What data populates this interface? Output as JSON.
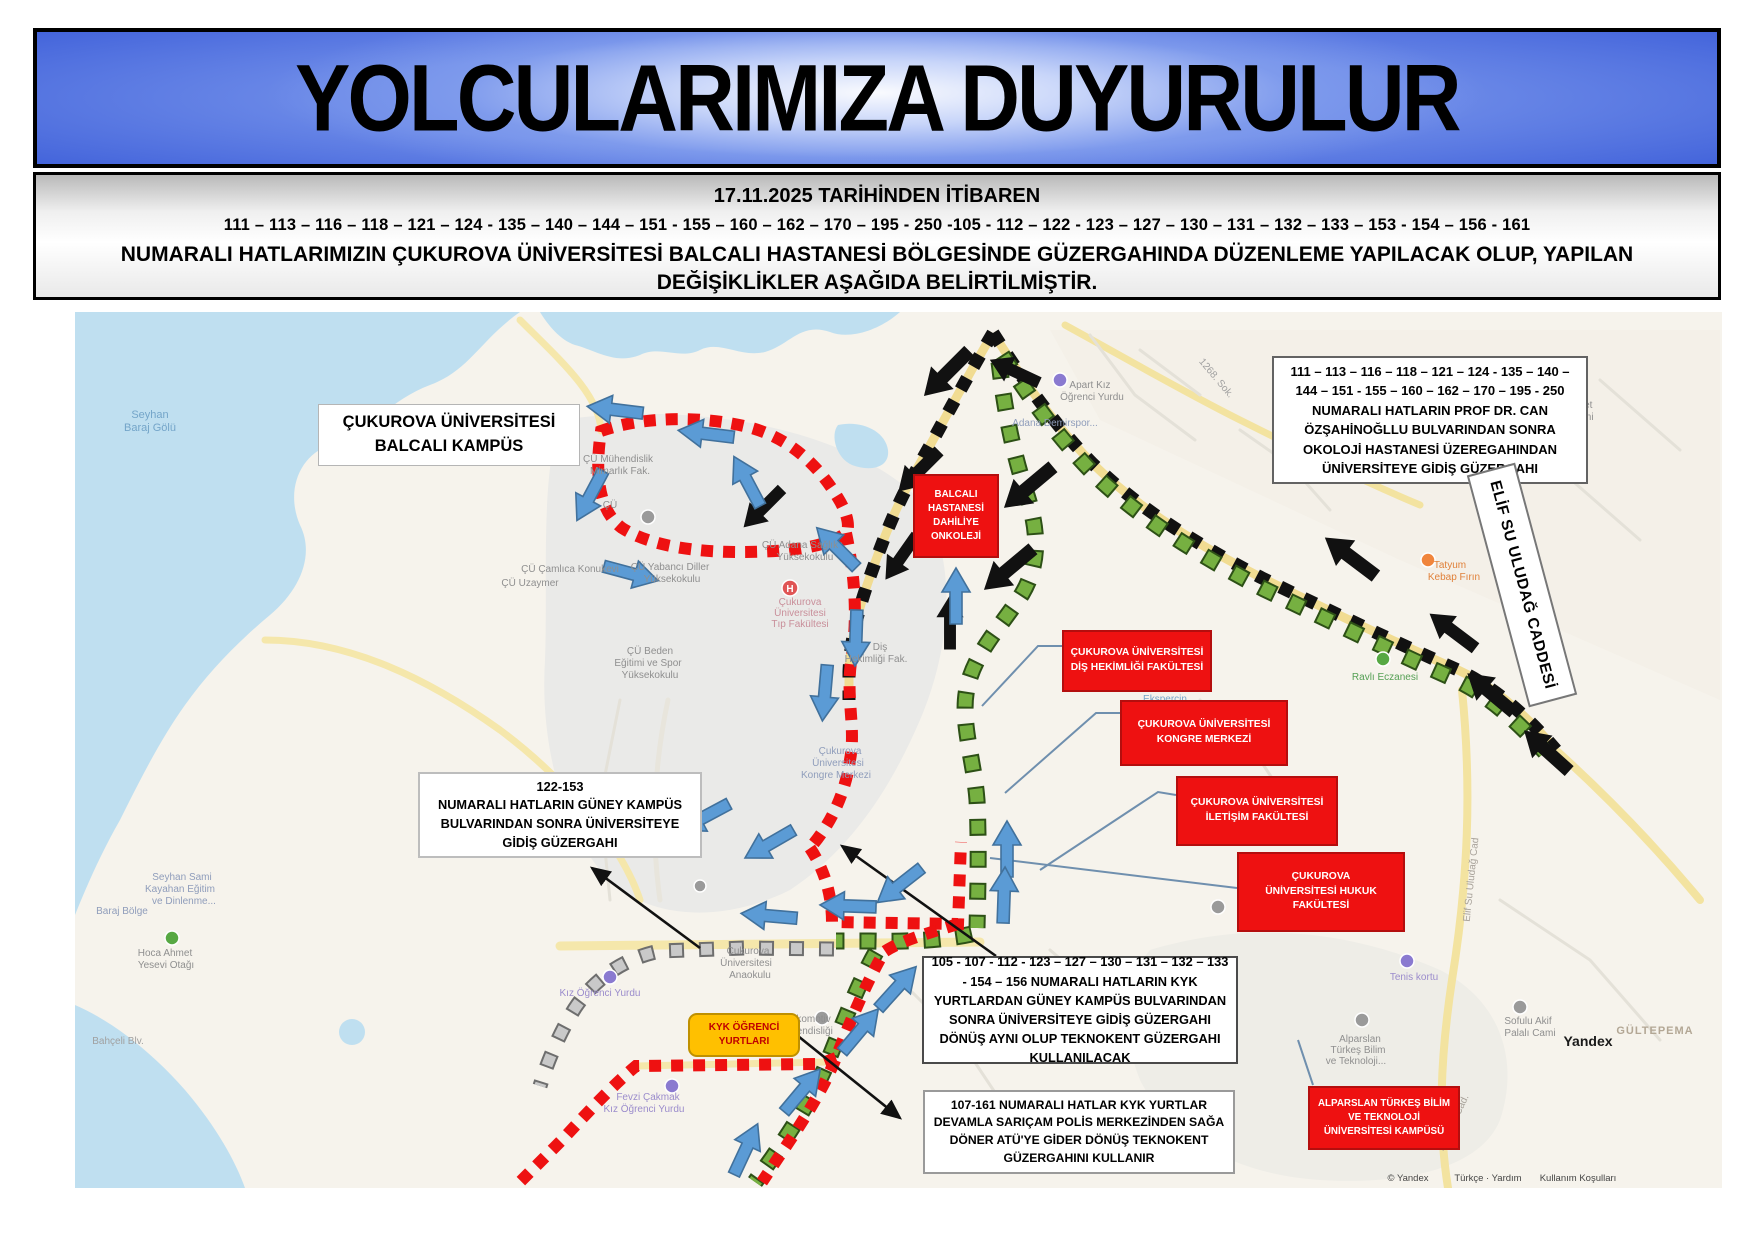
{
  "header": {
    "title": "YOLCULARIMIZA DUYURULUR"
  },
  "notice": {
    "line1": "17.11.2025 TARİHİNDEN İTİBAREN",
    "line2": "111 – 113 – 116 – 118 – 121 – 124 - 135 – 140 – 144 – 151 - 155 – 160 – 162 – 170 – 195 - 250 -105 - 112 – 122 - 123 – 127 – 130 – 131 – 132 – 133 – 153 - 154 – 156  - 161",
    "line3": "NUMARALI  HATLARIMIZIN ÇUKUROVA ÜNİVERSİTESİ BALCALI HASTANESİ BÖLGESİNDE GÜZERGAHINDA  DÜZENLEME YAPILACAK OLUP, YAPILAN DEĞİŞİKLİKLER AŞAĞIDA BELİRTİLMİŞTİR."
  },
  "map": {
    "colors": {
      "red_route": "#ee1111",
      "black_route": "#111111",
      "green_route": "#6ab04c",
      "gray_route": "#c9c9c9",
      "arrow_blue": "#5b9bd5",
      "callout_red": "#ee1111",
      "kyk_orange": "#ffc000"
    },
    "callouts": {
      "balcali_kampus": {
        "line1": "ÇUKUROVA ÜNİVERSİTESİ",
        "line2": "BALCALI KAMPÜS"
      },
      "route_ne": "111 – 113 – 116 – 118 – 121 – 124 - 135 – 140 – 144 – 151 - 155 – 160 – 162 – 170 – 195 - 250  NUMARALI HATLARIN PROF DR. CAN ÖZŞAHİNOĞLLU BULVARINDAN SONRA OKOLOJİ HASTANESİ ÜZEREGAHINDAN ÜNİVERSİTEYE GİDİŞ GÜZERGAHI",
      "balcali_hastanesi": "BALCALI HASTANESİ DAHİLİYE ONKOLEJİ",
      "dis_hekimligi": "ÇUKUROVA ÜNİVERSİTESİ DİŞ HEKİMLİĞİ FAKÜLTESİ",
      "kongre_merkezi": "ÇUKUROVA ÜNİVERSİTESİ KONGRE MERKEZİ",
      "iletisim_fakultesi": "ÇUKUROVA ÜNİVERSİTESİ İLETİŞİM FAKÜLTESİ",
      "hukuk_fakultesi": "ÇUKUROVA ÜNİVERSİTESİ HUKUK FAKÜLTESİ",
      "alparslan": "ALPARSLAN TÜRKEŞ BİLİM VE TEKNOLOJİ ÜNİVERSİTESİ KAMPÜSÜ",
      "box_105": "105 - 107 - 112  - 123 – 127 – 130 – 131 – 132 – 133 - 154 – 156  NUMARALI HATLARIN KYK YURTLARDAN GÜNEY KAMPÜS BULVARINDAN SONRA ÜNİVERSİTEYE GİDİŞ GÜZERGAHI DÖNÜŞ AYNI OLUP TEKNOKENT GÜZERGAHI KULLANILACAK",
      "box_107": "107-161 NUMARALI HATLAR KYK YURTLAR DEVAMLA SARIÇAM POLİS MERKEZİNDEN SAĞA DÖNER ATÜ'YE GİDER DÖNÜŞ TEKNOKENT GÜZERGAHINI KULLANIR",
      "box_122_heading": "122-153",
      "box_122_body": "NUMARALI HATLARIN GÜNEY KAMPÜS BULVARINDAN SONRA ÜNİVERSİTEYE GİDİŞ GÜZERGAHI",
      "kyk": "KYK ÖĞRENCİ YURTLARI",
      "elif_su": "ELİF SU ULUDAĞ CADDESİ"
    },
    "labels": {
      "seyhan1": "Seyhan",
      "seyhan2": "Baraj Gölü",
      "muh1": "ÇÜ Mühendislik",
      "muh2": "Mimarlık Fak.",
      "cu": "ÇÜ",
      "camlica": "ÇÜ Çamlıca Konukevi",
      "uzaymer": "ÇÜ Uzaymer",
      "diller1": "ÇÜ Yabancı Diller",
      "diller2": "Yüksekokulu",
      "saglik1": "ÇÜ Adana Sağlık",
      "saglik2": "Yüksekokulu",
      "tip1": "Çukurova",
      "tip2": "Üniversitesi",
      "tip3": "Tıp Fakültesi",
      "beden1": "ÇÜ Beden",
      "beden2": "Eğitimi ve Spor",
      "beden3": "Yüksekokulu",
      "dis1": "Diş",
      "dis2": "Hekimliği Fak.",
      "kongre1": "Çukurova",
      "kongre2": "Üniversitesi",
      "kongre3": "Kongre Merkezi",
      "mithat": "Mithat Özsan Blv.",
      "ana1": "Çukurova",
      "ana2": "Üniversitesi",
      "ana3": "Anaokulu",
      "loko1": "Lokomotiv",
      "loko2": "Mühendisliği",
      "fevzi1": "Fevzi Çakmak",
      "fevzi2": "Kız Öğrenci Yurdu",
      "kiz_yurt": "Kız Öğrenci Yurdu",
      "demirspor": "Adana Demirspor...",
      "apart1": "Apart Kız",
      "apart2": "Öğrenci Yurdu",
      "sok1268": "1268. Sok.",
      "tatyum1": "Tatyum",
      "tatyum2": "Kebap Fırın",
      "ravli": "Ravlı Eczanesi",
      "ekspercin": "Eksperçin",
      "tenis": "Tenis kortu",
      "alp1": "Alparslan",
      "alp2": "Türkeş Bilim",
      "alp3": "ve Teknoloji...",
      "toki1": "Toki Ahmet",
      "toki2": "Yesevi Cami",
      "gultepe": "GÜLTEPEMA",
      "sofulu1": "Sofulu Akif",
      "sofulu2": "Palalı Cami",
      "yandex_logo": "Yandex",
      "bahceli": "Bahçeli Blv.",
      "hoca1": "Hoca Ahmet",
      "hoca2": "Yesevi Otağı",
      "sami1": "Seyhan Sami",
      "sami2": "Kayahan Eğitim",
      "sami3": "ve Dinlenme...",
      "baraj_bolge": "Baraj Bölge",
      "kayahane": "Kayahane",
      "elif_cad": "Elif Su Uludağ Cad",
      "boztepe": "Boztepe Cad.",
      "hospital_h": "H"
    },
    "attribution": {
      "copyright": "© Yandex",
      "links1": "Türkçe · Yardım",
      "links2": "Kullanım Koşulları"
    }
  }
}
